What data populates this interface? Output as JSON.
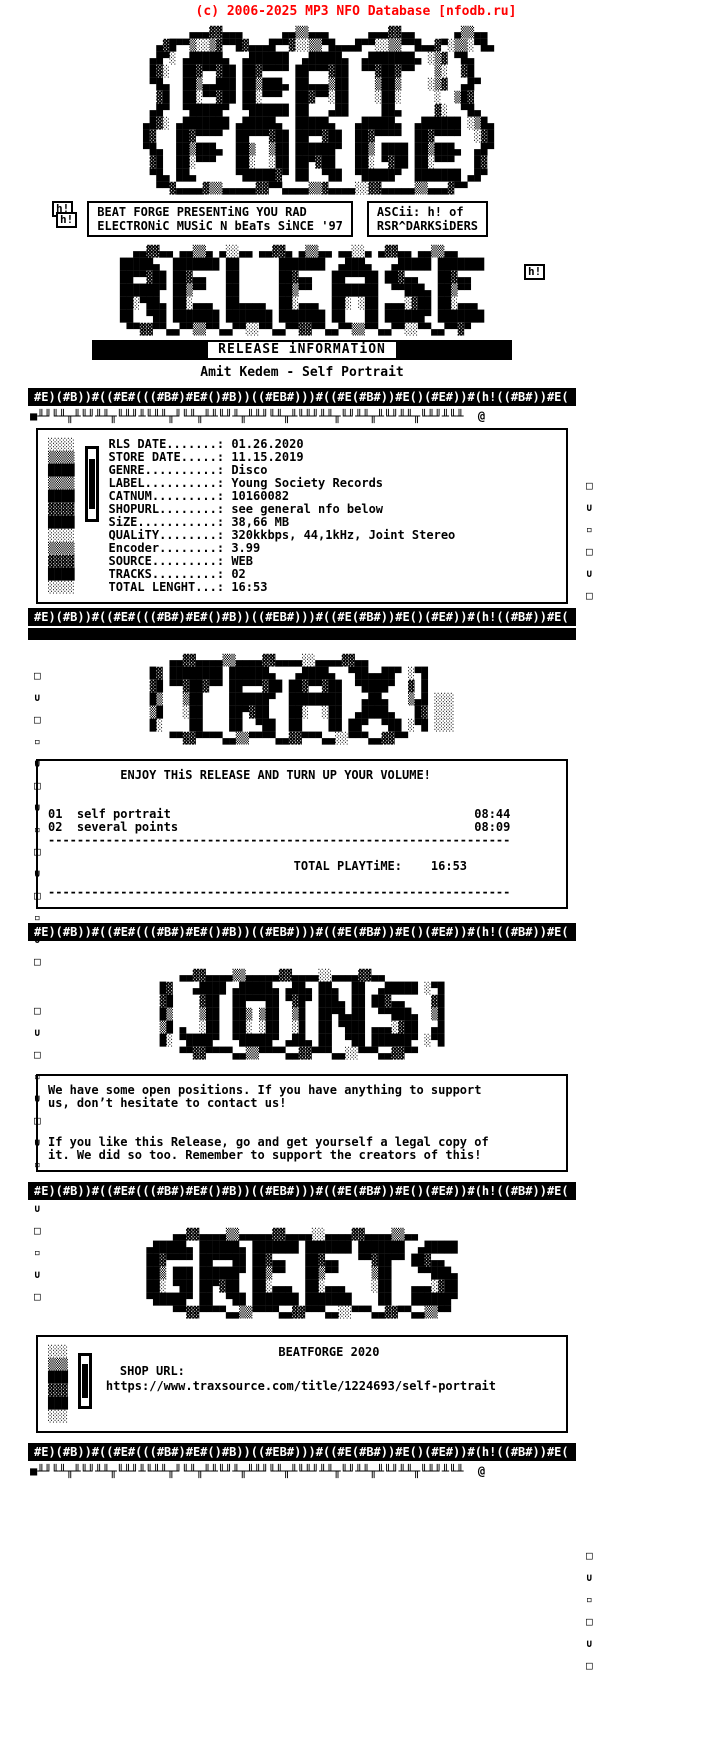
{
  "colors": {
    "accent_red": "#ff0000",
    "ink": "#000000",
    "background": "#ffffff"
  },
  "site_header": {
    "text": "(c) 2006-2025 MP3 NFO Database [nfodb.ru]"
  },
  "credits": {
    "badge": "h!",
    "line1": "BEAT FORGE PRESENTiNG YOU RAD",
    "line2": "ELECTRONiC MUSiC N bEaTs SiNCE '97",
    "ascii_credit_line1": "ASCii: h! of",
    "ascii_credit_line2": "RSR^DARKSiDERS"
  },
  "release_header": {
    "bar_label": "RELEASE iNFORMATiON",
    "title": "Amit Kedem  - Self Portrait"
  },
  "release_info": {
    "fields": [
      {
        "label": "RLS DATE",
        "value": "01.26.2020"
      },
      {
        "label": "STORE DATE",
        "value": "11.15.2019"
      },
      {
        "label": "GENRE",
        "value": "Disco"
      },
      {
        "label": "LABEL",
        "value": "Young Society Records"
      },
      {
        "label": "CATNUM",
        "value": "10160082"
      },
      {
        "label": "SHOPURL",
        "value": "see general nfo below"
      },
      {
        "label": "SiZE",
        "value": "38,66 MB"
      },
      {
        "label": "QUALiTY",
        "value": "320kkbps, 44,1kHz, Joint Stereo"
      },
      {
        "label": "Encoder",
        "value": "3.99"
      },
      {
        "label": "SOURCE",
        "value": "WEB"
      },
      {
        "label": "TRACKS",
        "value": "02"
      },
      {
        "label": "TOTAL LENGHT",
        "value": "16:53"
      }
    ]
  },
  "tracklist": {
    "enjoy_line": "ENJOY THiS RELEASE AND TURN UP YOUR VOLUME!",
    "tracks": [
      {
        "num": "01",
        "title": "self portrait",
        "time": "08:44"
      },
      {
        "num": "02",
        "title": "several points",
        "time": "08:09"
      }
    ],
    "total_label": "TOTAL PLAYTiME:",
    "total_time": "16:53"
  },
  "join": {
    "para1": "We have some open positions. If you have anything to support\nus, don’t hesitate to contact us!",
    "para2": "If you like this Release, go and get yourself a legal copy of\nit. We did so too. Remember to support the creators of this!"
  },
  "footer": {
    "brand_line": "BEATFORGE 2020",
    "shop_url_label": "SHOP URL:",
    "shop_url": "https://www.traxsource.com/title/1224693/self-portrait"
  },
  "ascii": {
    "beatforge_logo": "            ▄▄▄▓▓▄▄▄      ▄▄▒▒▄▄▄      ▄▄▄▓▓▄▄      ▄▒▒▄▄\n       ▄▓█▀▀▒░░▒▓▀▀█▓▄▄▄█▀▀▓░░▒▒▀█▄▄▄█▀▀░░▒▒▀▀█▄▄▓▀░▒▒░▀█▄\n      ▄█▀░ ▄█████▄  ▄██████  ▄█████▄  ▄███████▄ ░▒▓ ▀█▄\n      █▓░  ██▓▀▀▓██ ██▓▀▀▀▀ ██▀▀▀▓██  ▀▀▓██▓▀▀   ▒░  ▓█\n      ▀█▄  ██▒▄▄███ ██▒███▄ ██▄▄▄▒██    ▒██▒    ░▒▓  ▄█▀\n       ▓█  ██░▀▀▓██ ██░▀▀▀  ██▓▀▀░██    ░██░     ░  ▒█▓\n      ▄█▀  ▀█████▀  ▀██████ ██   ▄██     ██▄     ▓░  ▀█▄\n     ▄█▓░ ▄███████ ▄█████▄  █████▄   ▄█████▄  ▄██████ ░▒█▄\n     █▓   ██▓▀▀▀▀  ██▀▀▀▓██ ██▀▀▓██  ██▓▀▀▀▀  ██▓▀▀▀▀  ░▓█\n     ▀█▄  ██▒███▄  ██▒  ▒██ ██████▀  ██▒ ████ ██▒███▄  ▄█▀\n      ▓█  ██░▀▀▀   ██░  ░██ ██▀▓██   ██░ ▀▓██ ██░▀▀▀   █▓\n      ▀█▄ ██▄      ▀█████▓▀ ██  ▀██  ▀█████▀  ███████ ▄█▀\n       ▀▀▓▄▄▄▄▓▒▒▄▄▄▄▄▓▓▀▀▄▄▄▄▒▒▓▄▄▄▄░░▓▓▄▄▄▄▄▒▒▄▄▄▓▀▀",
    "release_logo": "  ▄▄▓▓▄▄ ▄▄▒▒▄ ▄░░▄▄ ▄▄▓▓▄ ▄▒▒▄▄ ▄▄░░▄ ▄▓▓▄▄ ▄▄▒▒▄▄\n█████▄  ███████ ██      ███████  ▄███▄   ▄█████ ███████\n██▀▀▓██ ██▓▄▄   ██      ██▓▄▄   ██▀▀▀██ ██▓▄▄   ██▓▄▄\n██████▀ ██▒▀▀   ██      ██▒▀▀   ███████  ▀▀███▄ ██▒▀▀\n██░▀██▄ ██░▄▄▄  ██▄▄▄▄  ██░▄▄▄  ██░ ░██ ▄▄▄░▓██ ██░▄▄▄\n██  ▀██ ███████ ███████ ███████ ██   ██ ██████▀ ███████\n ▀▀▓▓▀▀▄▄▀▀▒▒▀▀▄▄▀▀░░▀▀▄▄▀▀▓▓▀▀▄▄▀▀▒▒▀▀▄▄▀▀░░▀▀▄▄▀▀▓▀",
    "trax_logo": "   ▄▄▓▓▄▄▄▄▒▒▄▄▄▄▓▓▄▄▄▄░░▄▄▄▄▓▓▄▄\n█▓ ████████ ██████▄   ▄████▄  ▀██▄▄██▀ ░▀█\n▓█ ▀▀▓██▓▀▀ ██▀▀▀▓██ ██▓▀▀▓██  ▀████▀  ▓ █\n█▒   ▒██    ██████▀  ████████   ▄██▄   ▒▄█ ░░░\n▒█   ░██    ██▀▓██   ██░  ░██  ▄████▄   █▓ ░░░\n█░    ██    ██  ▀██  ██    ██ ██▀  ▀██ ░▀█ ░░░\n   ▀▀▓▓▀▀▀▀▄▄▒▒▀▀▀▀▄▄▓▓▀▀▀▄▄░░▀▀▀▄▄▓▓▀▀",
    "joins_logo": "   ▄▄▓▓▄▄▄▄▒▒▄▄▄▄▄▓▓▄▄▄▄░░▄▄▄▄▓▓▄▄\n█▓   ▄████ ▄█████▄ ▄██▄ ██▄  ██  ▄█████ ░▀█\n▓█    ▓██  ██▀▀▀██ ▀▓█▀ ███▄ ██ ██▓▄▄    ▓█\n█▒    ▒██  ██▒ ▒██  ▒█  ██▀█▄██  ▀▀███▄  ▒█\n▒█ ▄  ░██  ██░ ░██  ░█  ██ ▀███ ▄▄▄░▓██  ▄█\n█░ ▀████▀  ▀█████▀ ▄██▄ ██  ▀██ ██████▀ ░▀█\n   ▀▀▓▓▀▀▀▀▄▄▒▒▀▀▀▀▄▄▓▓▀▀▀▄▄░░▀▀▀▄▄▓▓▀▀",
    "greets_logo": "    ▄▄▓▓▄▄▄▄▒▒▄▄▄▄▄▓▓▄▄▄▄░░▄▄▄▄▓▓▄▄▄▄▒▒▄▄\n▄█████▄ ██████▄ ███████ ███████ ███████  ▄█████\n██▓▀▀▀▀ ██▀▀▀██ ██▓▄▄   ██▓▄▄   ▀▀▓██▀▀ ██▓▄▄\n██▒ ███ ██████▀ ██▒▀▀   ██▒▀▀     ▒██    ▀▀███▄\n██░ ▀██ ██▀▓██  ██░▄▄▄  ██░▄▄▄    ░██   ▄▄▄░▓██\n▀█████▀ ██  ▀██ ███████ ███████    ██   ██████▀\n    ▀▀▓▓▀▀▀▀▄▄▒▒▀▀▀▀▄▄▓▓▀▀▀▄▄░░▀▀▀▄▄▓▓▀▀▄▄▒▒▀▀",
    "border_heavy": "#E)(#B))#((#E#(((#B#)#E#()#B))((#EB#)))#((#E(#B#))#E()(#E#))#(h!((#B#))#E(",
    "border_small": "■╨╜╙╨╥╨╙╜╨╨╥╙╨╜╨╙╨╨╥╜╙╨╥╨╨╙╜╨╥╨╨╜╙╨╥╨╙╨╜╨╨╥╙╜╨╨╥╨╙╜╨╨╥╙╨╜╨╙╨  @",
    "grad_col": "░░░░\n▒▒▒▒\n████\n▒▒▒▒\n████\n▓▓▓▓\n████\n░░░░\n▒▒▒▒\n▓▓▓▓\n████\n░░░░",
    "grad_col_small": "░░░\n▒▒▒\n███\n▓▓▓\n███\n░░░",
    "deco_col": "□\n∪\n□\n▫\n∪\n□\n∪\n▫\n□\n∪\n□\n▫\n∪\n□",
    "deco_col_short": "□\n∪\n▫\n□\n∪\n□"
  }
}
